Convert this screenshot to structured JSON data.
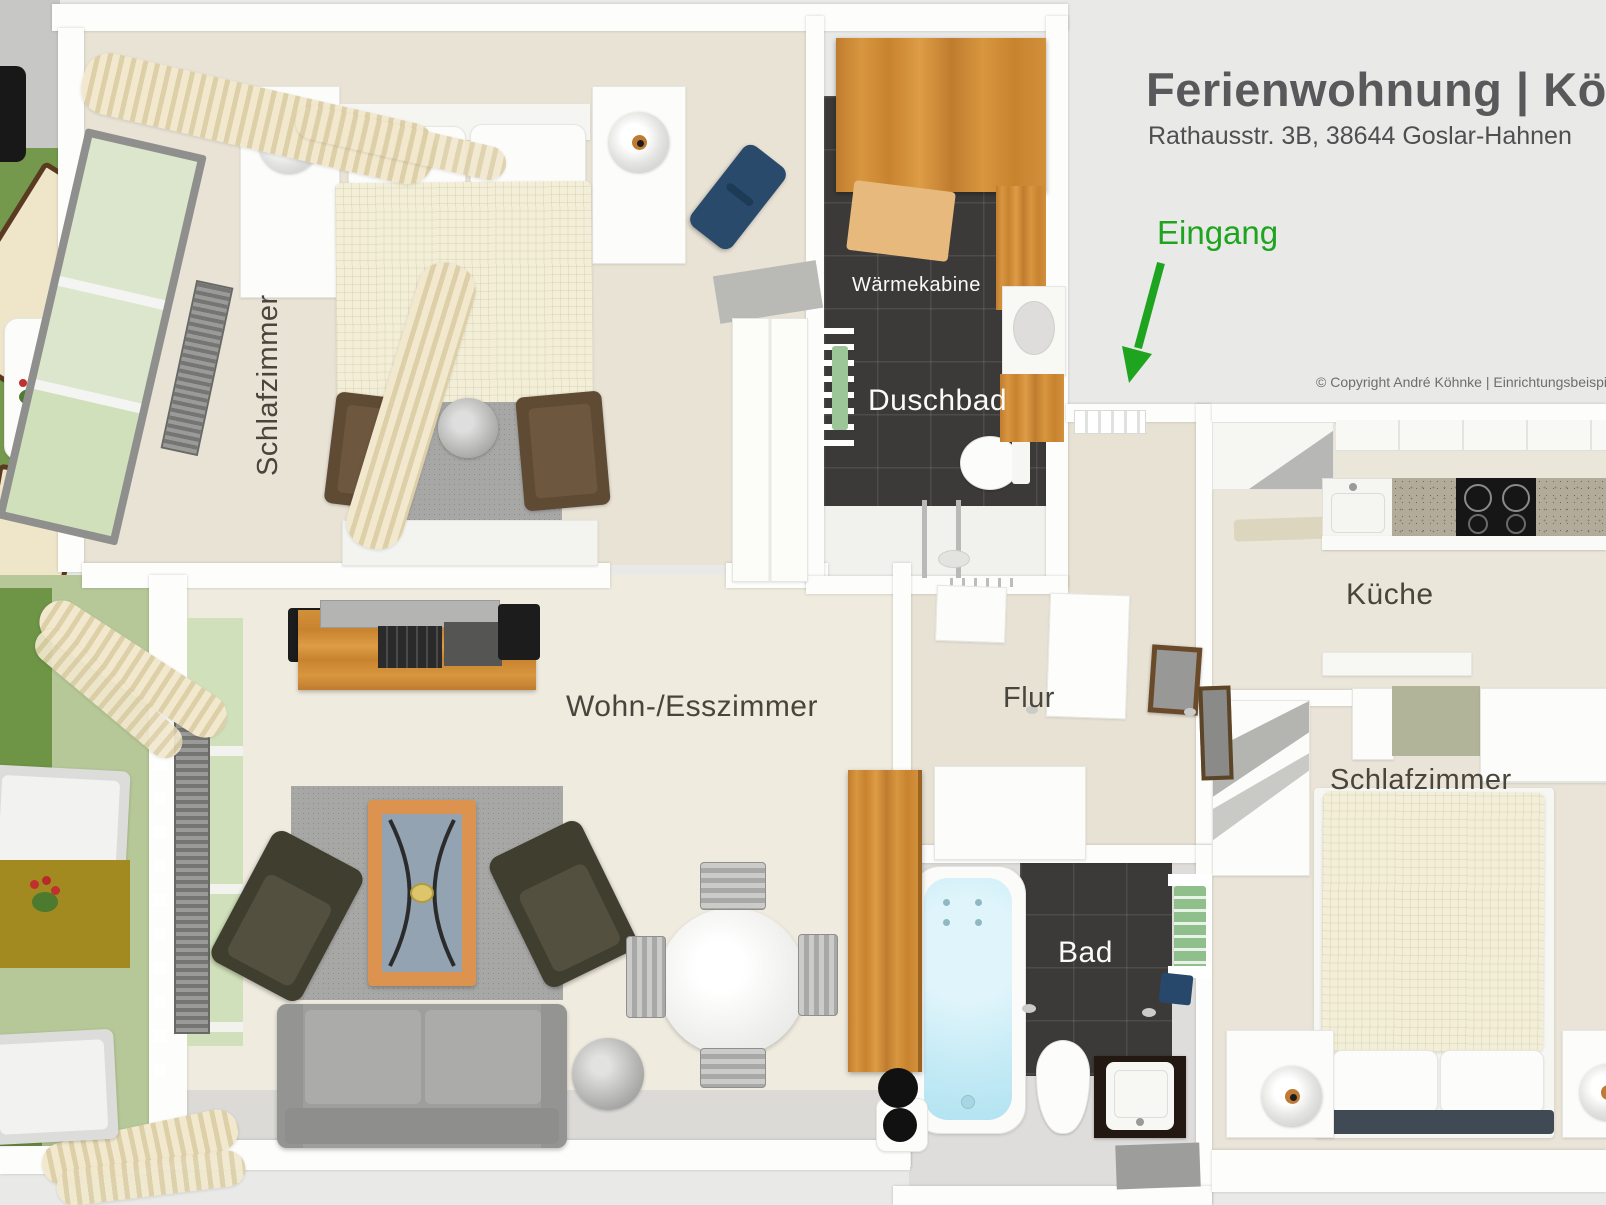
{
  "header": {
    "title": "Ferienwohnung | Kö",
    "subtitle": "Rathausstr. 3B, 38644 Goslar-Hahnen",
    "copyright": "© Copyright André Köhnke | Einrichtungsbeispi"
  },
  "entrance": {
    "label": "Eingang"
  },
  "rooms": {
    "bedroom_top": {
      "label": "Schlafzimmer"
    },
    "heat_cabin": {
      "label": "Wärmekabine"
    },
    "shower_bath": {
      "label": "Duschbad"
    },
    "hallway": {
      "label": "Flur"
    },
    "kitchen": {
      "label": "Küche"
    },
    "bedroom_right": {
      "label": "Schlafzimmer"
    },
    "bath": {
      "label": "Bad"
    },
    "living_dining": {
      "label": "Wohn-/Esszimmer"
    }
  },
  "colors": {
    "background": "#e9e9e7",
    "wall": "#fdfdfc",
    "floor_beige": "#ebe6da",
    "dark_tile": "#3c3a38",
    "wood": "#d0883a",
    "balcony_green_dark": "#74994c",
    "balcony_green_light": "#b6c897",
    "bathtub_blue": "#c2eaf5",
    "entrance_green": "#1ea41e",
    "label_dark": "#48453c",
    "label_light": "#fafaf8",
    "title_gray": "#59595b",
    "sofa_gray": "#9e9e9c",
    "armchair_olive": "#403e2e",
    "bed_blanket_cream": "#f3eed8",
    "navy_accent": "#2a4a6c",
    "mustard_rug": "#a38a20"
  }
}
